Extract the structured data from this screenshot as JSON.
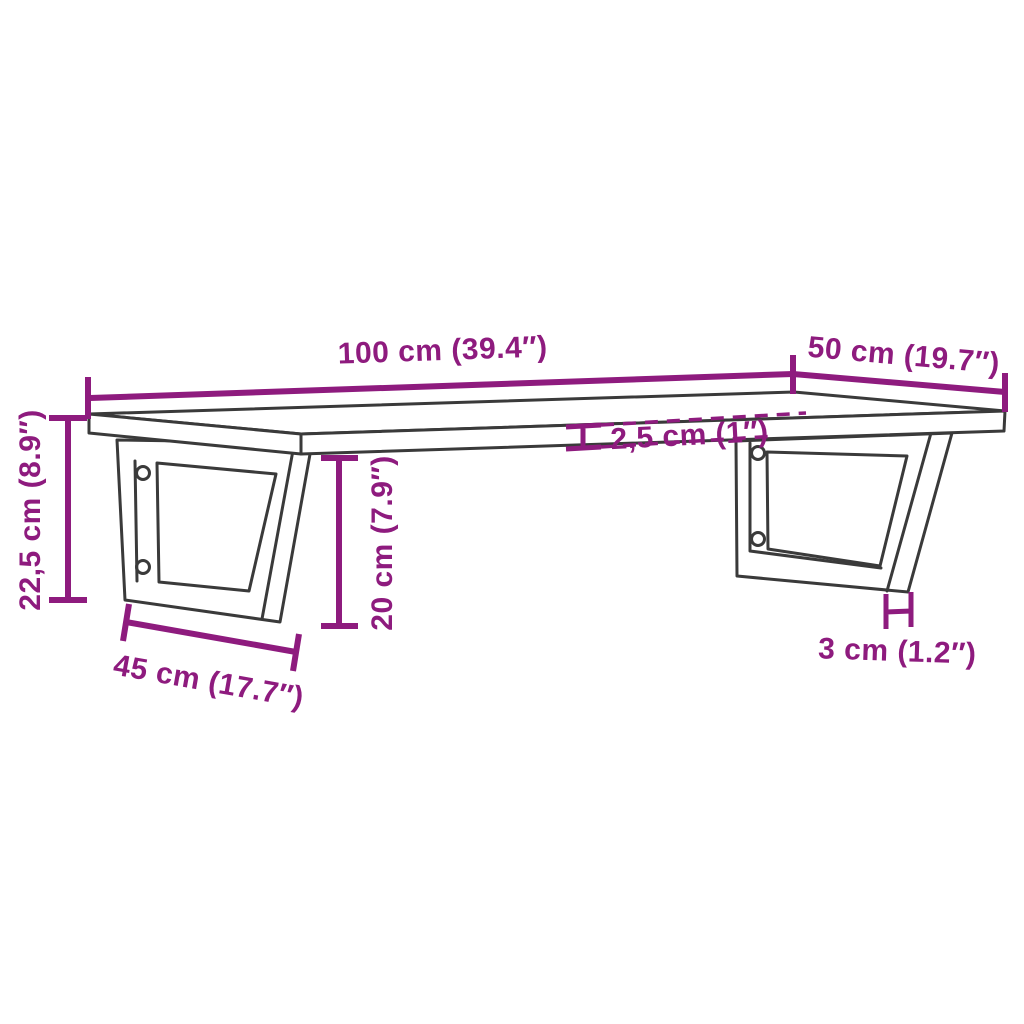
{
  "accent_color": "#8E1B7E",
  "outline_color": "#3A3A3A",
  "labels": {
    "shelf_length": "100 cm (39.4″)",
    "shelf_depth": "50 cm (19.7″)",
    "shelf_thickness": "2,5 cm (1″)",
    "total_height": "22,5 cm (8.9″)",
    "bracket_height": "20 cm (7.9″)",
    "bracket_depth": "45 cm (17.7″)",
    "bracket_foot_width": "3 cm (1.2″)"
  }
}
